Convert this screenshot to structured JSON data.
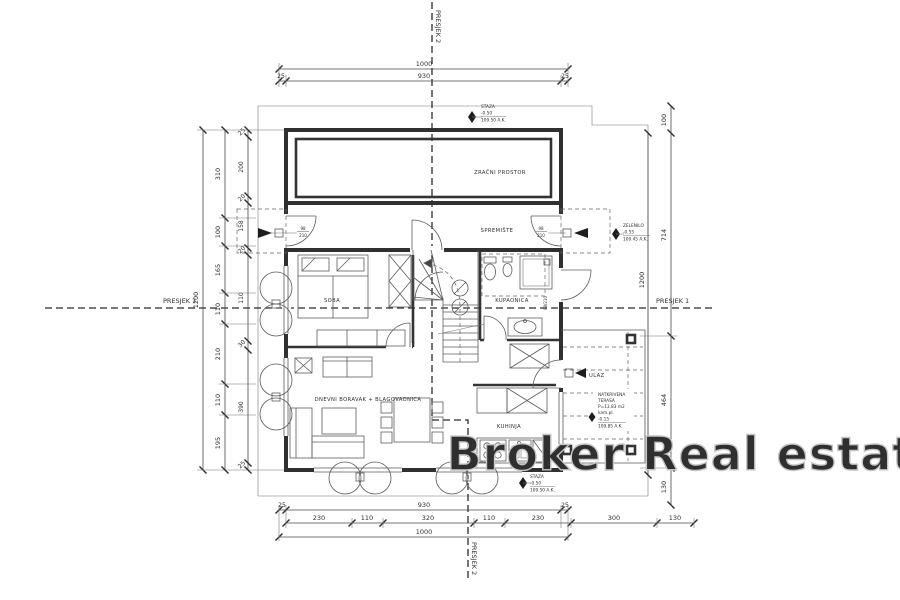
{
  "watermark": {
    "text": "Broker Real estate",
    "color": "#c6c6c6"
  },
  "sections": {
    "s1": "PRESJEK 1",
    "s2": "PRESJEK 2"
  },
  "rooms": {
    "zracni": "ZRAČNI PROSTOR",
    "spremiste": "SPREMIŠTE",
    "soba": "SOBA",
    "kupaonica": "KUPAONICA",
    "dnevni": "DNEVNI BORAVAK + BLAGOVAONICA",
    "kuhinja": "KUHINJA",
    "ulaz": "ULAZ"
  },
  "terasa": {
    "l1": "NATKRIVENA",
    "l2": "TERASA",
    "l3": "P=13.83 m2",
    "l4": "kam.pl.",
    "l5": "-0.15",
    "l6": "109.85 A.K."
  },
  "levels": {
    "staza_top": {
      "name": "STAZA",
      "level": "-0.50",
      "elev": "109.50 A.K."
    },
    "staza_bottom": {
      "name": "STAZA",
      "level": "-0.50",
      "elev": "109.50 A.K."
    },
    "zelenilo": {
      "name": "ZELENILO",
      "level": "-0.55",
      "elev": "109.45 A.K."
    }
  },
  "dims": {
    "top": {
      "overall": "1000",
      "inner": "930",
      "side": "25"
    },
    "left": {
      "overall": "1200",
      "mid": [
        "310",
        "100",
        "165",
        "110",
        "210",
        "110",
        "195"
      ],
      "inner": [
        "25",
        "200",
        "20",
        "158",
        "20",
        "110",
        "30",
        "390",
        "25"
      ]
    },
    "right": {
      "overall": "1200",
      "chain": [
        "100",
        "714",
        "464",
        "130"
      ]
    },
    "bottom": {
      "row1": [
        "25",
        "930",
        "25"
      ],
      "row2": [
        "230",
        "110",
        "320",
        "110",
        "230",
        "300",
        "130"
      ],
      "row3": "1000"
    }
  },
  "door_size": {
    "w": "98",
    "h": "210",
    "inline": "98/210"
  }
}
